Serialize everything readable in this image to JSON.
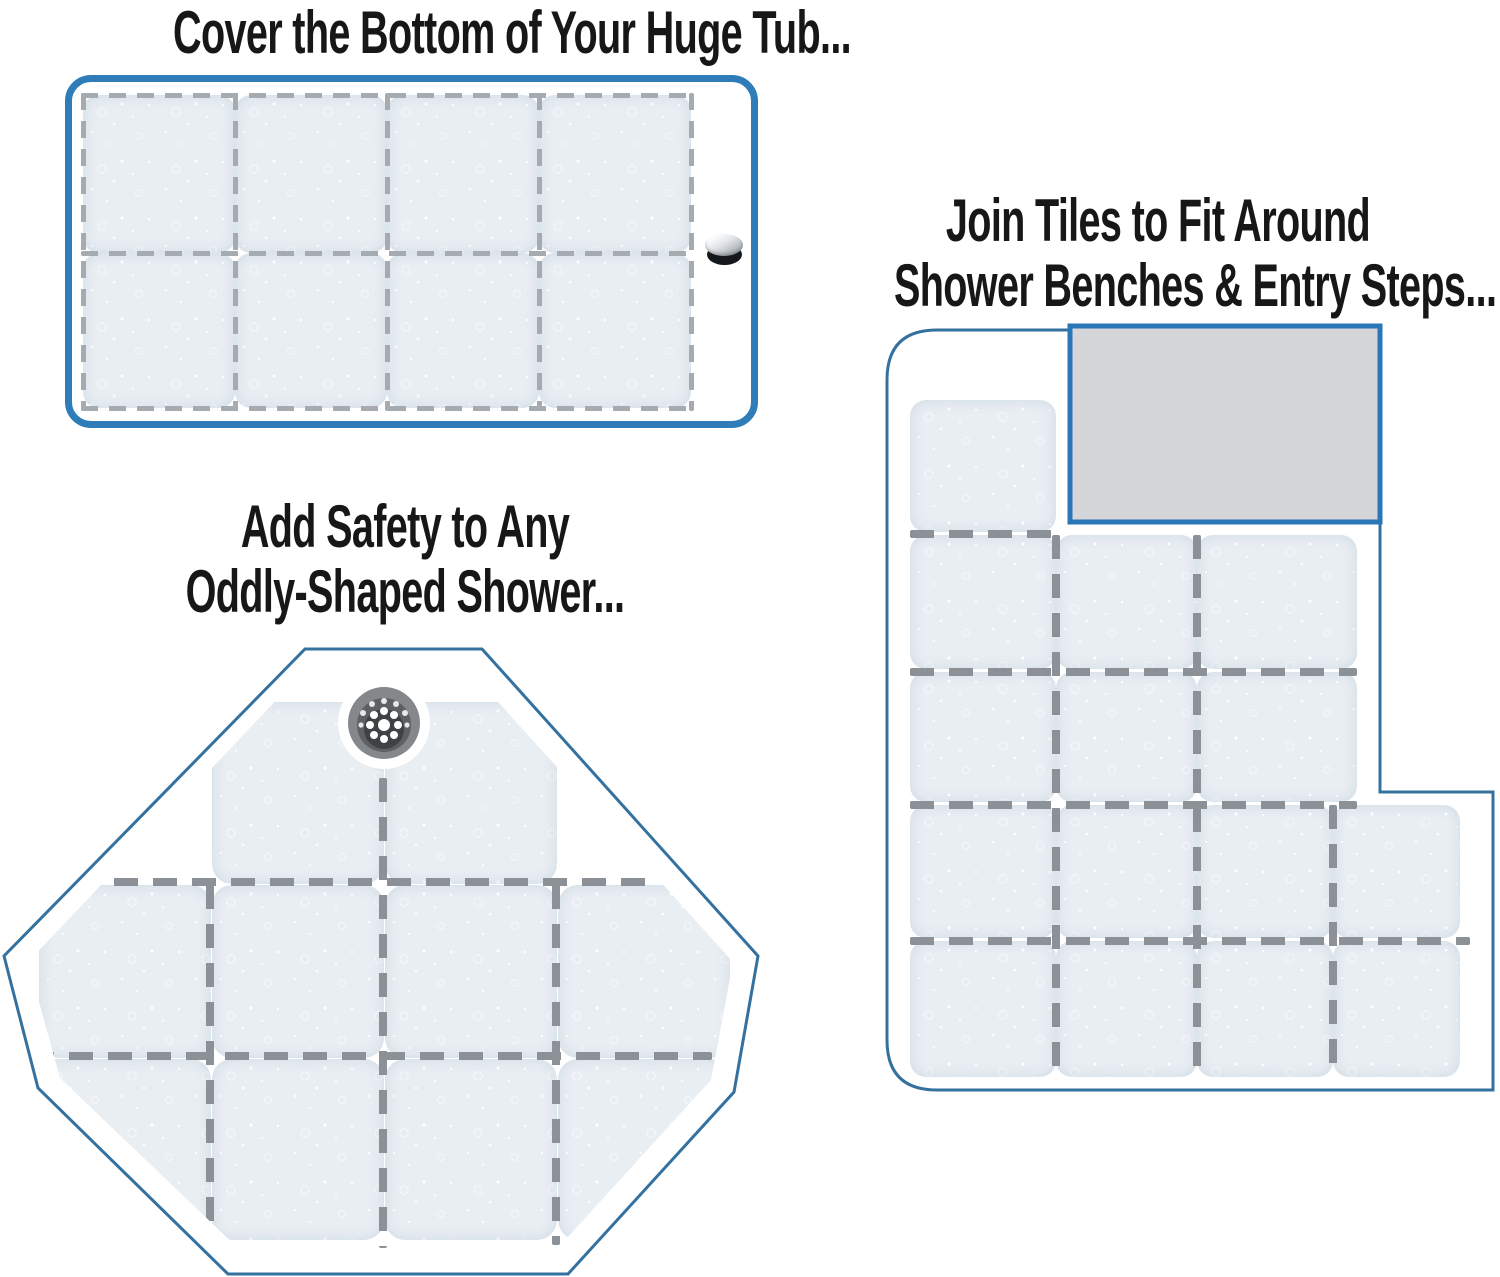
{
  "image": {
    "width": 1500,
    "height": 1277,
    "background": "#ffffff"
  },
  "colors": {
    "title_text": "#171717",
    "tub_border_blue": "#2e7cb8",
    "shower_outline_blue": "#35719f",
    "bench_fill": "#d4d6d9",
    "bench_border_blue": "#2a77b8",
    "tile_fill": "#e9eef3",
    "seam_dash_gray": "#8b9197",
    "tub_seam_dash_gray": "#a5abb0",
    "drain_gray": "#85888b"
  },
  "icons": {
    "tub_drain": "pop-up-drain-plug-icon",
    "shower_drain": "round-shower-drain-grate-icon"
  },
  "panels": {
    "tub": {
      "title": "Cover the Bottom of Your Huge Tub...",
      "tile_columns": 4,
      "tile_rows": 2
    },
    "odd_shower": {
      "title_lines": [
        "Add Safety to Any",
        "Oddly-Shaped Shower..."
      ],
      "shape": "octagon",
      "tile_count": 10
    },
    "bench_shower": {
      "title_lines": [
        "Join Tiles to Fit Around",
        "Shower Benches & Entry Steps..."
      ],
      "shape": "l-shaped-with-bench",
      "tile_count": 15
    }
  }
}
